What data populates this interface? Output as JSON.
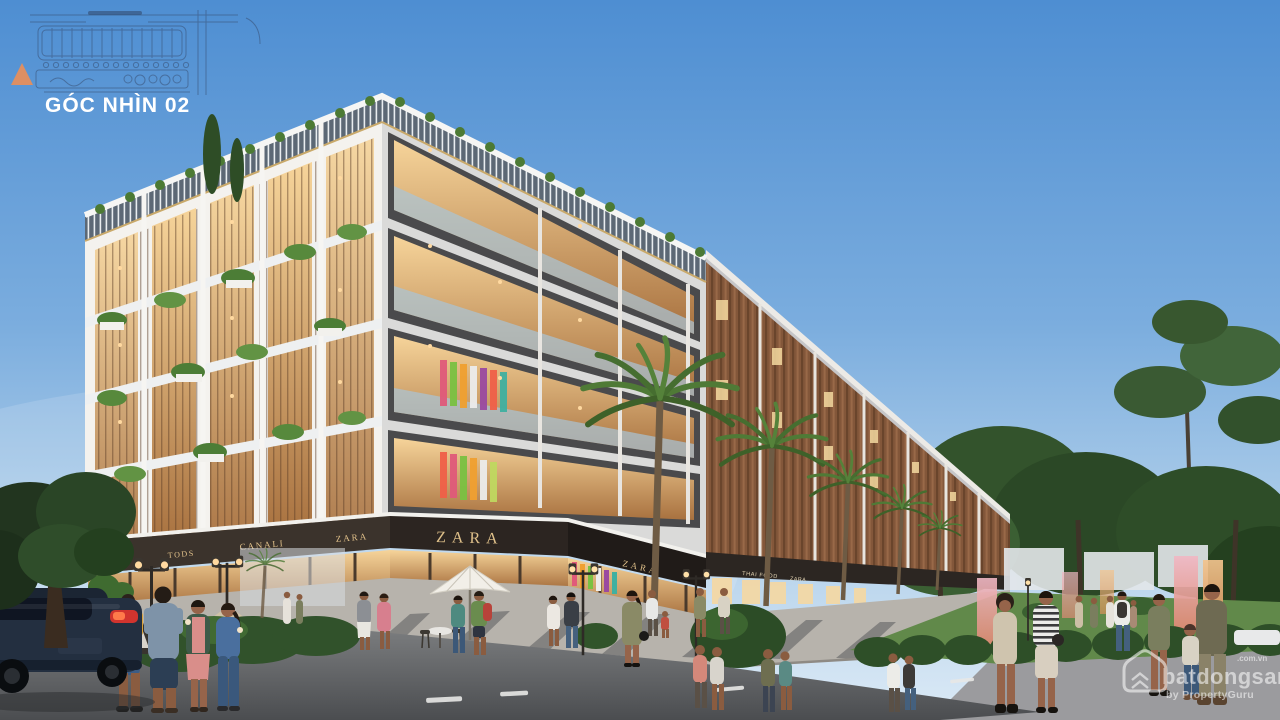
{
  "scene_title": {
    "label": "GÓC NHÌN 02"
  },
  "site_plan": {
    "inset_name": "master-plan-line-drawing",
    "marker_icon": "view-direction-triangle-icon",
    "marker_color": "#dd8f63"
  },
  "signs": {
    "left_fascia": [
      "BOSS",
      "TODS",
      "CANALI",
      "ZARA"
    ],
    "corner_main": "ZARA",
    "corner_side": "ZARA",
    "row": [
      "THAI FOOD",
      "ZARA"
    ]
  },
  "watermark": {
    "icon": "house-logo-icon",
    "brand": "batdongsan",
    "domain": ".com.vn",
    "tagline": "by PropertyGuru"
  },
  "colors": {
    "sky_top": "#4e8ed2",
    "sky_horizon": "#dceaf6",
    "accent_marker": "#dd8f63",
    "sign_gold": "#e2c28b",
    "facade_white": "#f2f1ed",
    "louver_terracotta": "#9a6239",
    "canopy_dark": "#332c27",
    "grass": "#61894a",
    "road": "#5d5f62"
  }
}
